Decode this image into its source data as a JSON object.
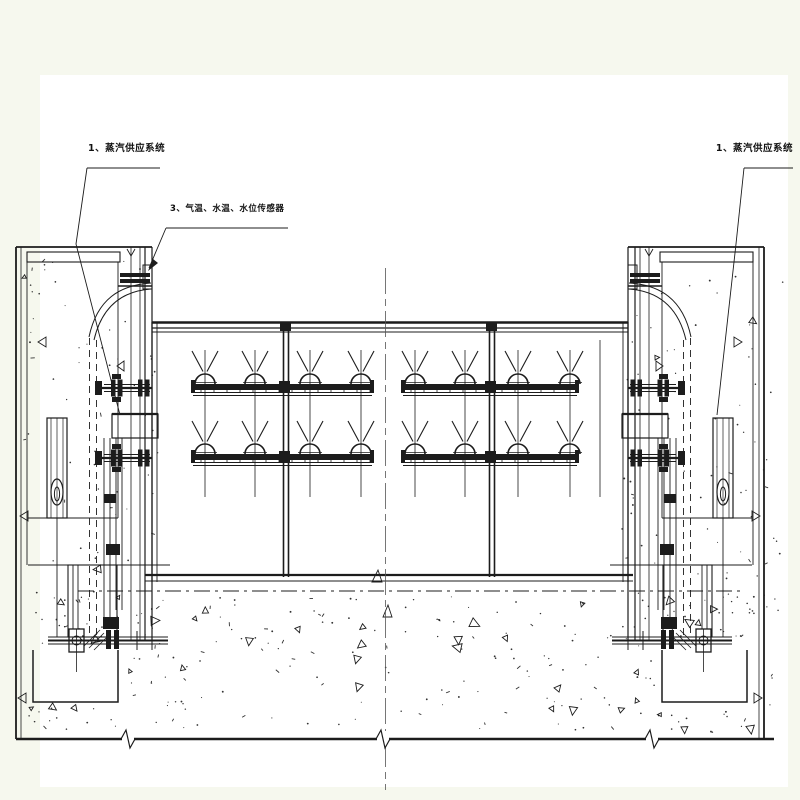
{
  "drawing": {
    "type": "engineering-section-drawing",
    "subject": "gate anti-freezing steam piping and sensor installation section",
    "labels": {
      "steam_supply_left": "1、蒸汽供应系统",
      "sensors": "3、气温、水温、水位传感器",
      "steam_supply_right": "1、蒸汽供应系统"
    },
    "colors": {
      "margin": "#f6f8ee",
      "paper": "#ffffff",
      "ink": "#1c1c1c",
      "centerline": "#555555"
    }
  }
}
